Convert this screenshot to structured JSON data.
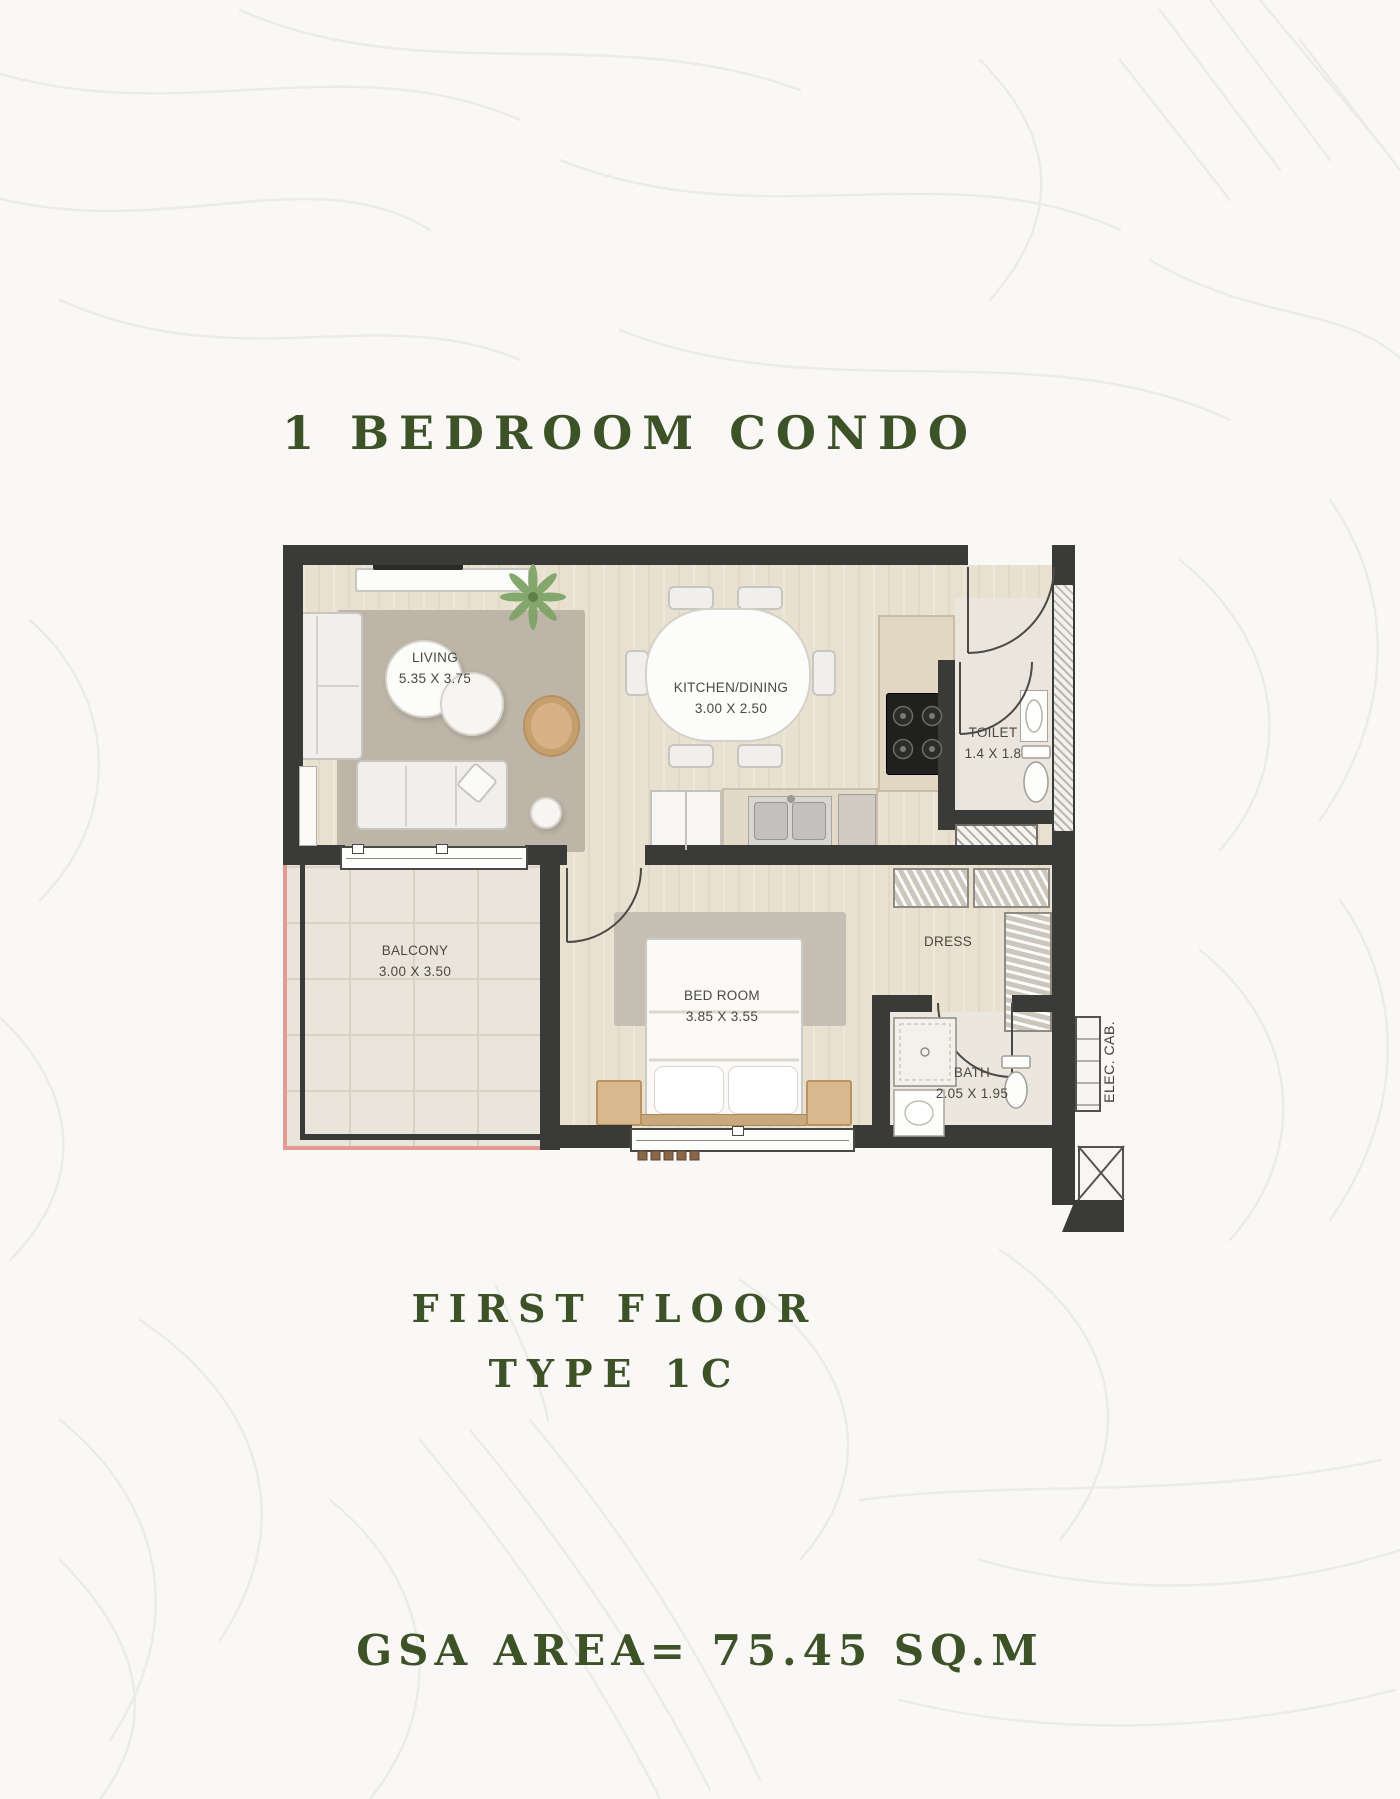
{
  "title": "1 BEDROOM CONDO",
  "floor_label": {
    "line1": "FIRST FLOOR",
    "line2": "TYPE 1C"
  },
  "area_label": "GSA AREA= 75.45 SQ.M",
  "colors": {
    "accent_green": "#3e5228",
    "wall": "#3a3a38",
    "wood_floor": "#e9e1d0",
    "balcony_tile": "#eae5da",
    "outline_red": "#e49a92",
    "label_text": "#4a4842"
  },
  "rooms": [
    {
      "id": "living",
      "name": "LIVING",
      "dims": "5.35 X 3.75"
    },
    {
      "id": "kitchen_dining",
      "name": "KITCHEN/DINING",
      "dims": "3.00 X 2.50"
    },
    {
      "id": "toilet",
      "name": "TOILET",
      "dims": "1.4 X 1.8"
    },
    {
      "id": "balcony",
      "name": "BALCONY",
      "dims": "3.00 X 3.50"
    },
    {
      "id": "bedroom",
      "name": "BED ROOM",
      "dims": "3.85 X 3.55"
    },
    {
      "id": "dress",
      "name": "DRESS",
      "dims": ""
    },
    {
      "id": "bath",
      "name": "BATH",
      "dims": "2.05 X 1.95"
    },
    {
      "id": "elec_cab",
      "name": "ELEC. CAB.",
      "dims": ""
    }
  ]
}
